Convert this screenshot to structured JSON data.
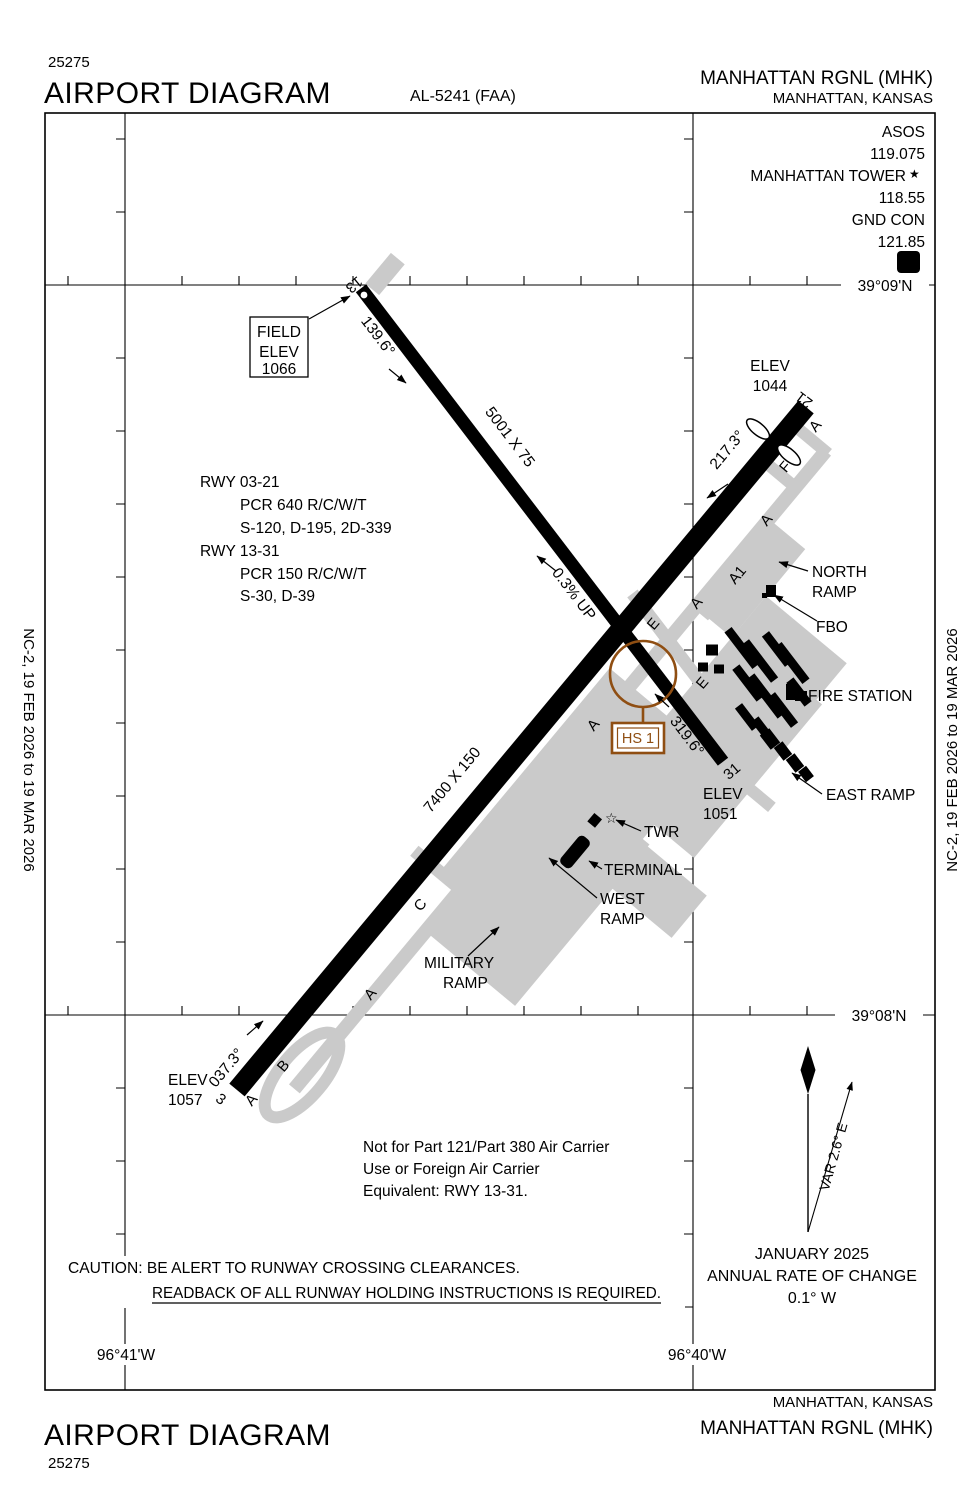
{
  "header": {
    "chart_number": "25275",
    "title": "AIRPORT DIAGRAM",
    "al_number": "AL-5241 (FAA)",
    "airport_name": "MANHATTAN RGNL (MHK)",
    "city": "MANHATTAN, KANSAS"
  },
  "footer": {
    "title": "AIRPORT DIAGRAM",
    "chart_number": "25275",
    "city": "MANHATTAN, KANSAS",
    "airport_name": "MANHATTAN RGNL (MHK)"
  },
  "margin_note": "NC-2,  19 FEB 2026  to  19 MAR 2026",
  "comm": {
    "asos_label": "ASOS",
    "asos_freq": "119.075",
    "tower_label": "MANHATTAN TOWER",
    "tower_star": "★",
    "tower_freq": "118.55",
    "gnd_label": "GND CON",
    "gnd_freq": "121.85",
    "hotspot_box_letter": "D"
  },
  "grid": {
    "lat_top": "39°09'N",
    "lat_bottom": "39°08'N",
    "lon_left": "96°41'W",
    "lon_right": "96°40'W"
  },
  "field_elev": {
    "line1": "FIELD",
    "line2": "ELEV",
    "line3": "1066"
  },
  "runway_13_31": {
    "num_13": "13",
    "num_31": "31",
    "hdg_13": "139.6°",
    "hdg_31": "319.6°",
    "dimensions": "5001 X 75",
    "slope": "0.3% UP",
    "elev_31_line1": "ELEV",
    "elev_31_line2": "1051"
  },
  "runway_03_21": {
    "num_3": "3",
    "num_21": "21",
    "hdg_3": "037.3°",
    "hdg_21": "217.3°",
    "dimensions": "7400 X 150",
    "elev_3_line1": "ELEV",
    "elev_3_line2": "1057",
    "elev_21_line1": "ELEV",
    "elev_21_line2": "1044"
  },
  "runway_data": [
    "RWY  03-21",
    "PCR 640 R/C/W/T",
    "S-120, D-195, 2D-339",
    "RWY  13-31",
    "PCR 150 R/C/W/T",
    "S-30, D-39"
  ],
  "features": {
    "north_ramp_line1": "NORTH",
    "north_ramp_line2": "RAMP",
    "fbo": "FBO",
    "fire_station": "FIRE STATION",
    "east_ramp": "EAST RAMP",
    "twr": "TWR",
    "tower_star": "☆",
    "terminal": "TERMINAL",
    "west_ramp_line1": "WEST",
    "west_ramp_line2": "RAMP",
    "military_ramp_line1": "MILITARY",
    "military_ramp_line2": "RAMP",
    "hot_spot": "HS 1"
  },
  "taxiways": [
    "A",
    "F",
    "A",
    "A1",
    "A",
    "E",
    "E",
    "A",
    "C",
    "A",
    "B",
    "A"
  ],
  "notes": {
    "part121_line1": "Not for Part 121/Part 380 Air Carrier",
    "part121_line2": "Use or Foreign Air Carrier",
    "part121_line3": "Equivalent: RWY 13-31.",
    "caution_line1": "CAUTION: BE ALERT TO RUNWAY CROSSING CLEARANCES.",
    "caution_line2": "READBACK OF ALL RUNWAY HOLDING INSTRUCTIONS IS REQUIRED."
  },
  "variation": {
    "var_label": "VAR 2.6° E",
    "date": "JANUARY 2025",
    "rate_line": "ANNUAL RATE OF CHANGE",
    "rate_value": "0.1° W"
  },
  "colors": {
    "ink": "#000000",
    "apron_gray": "#cacaca",
    "hotspot_brown": "#8f4e12"
  }
}
